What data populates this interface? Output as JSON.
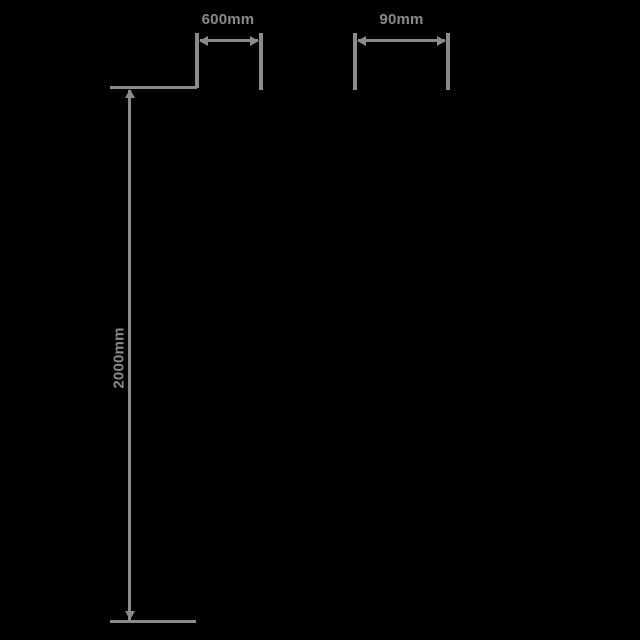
{
  "diagram": {
    "type": "product-dimension-drawing",
    "background_color": "#000000",
    "line_color": "#8a8a8a",
    "dimensions": {
      "width": {
        "label": "600mm",
        "orientation": "horizontal",
        "position": "top-left"
      },
      "depth": {
        "label": "90mm",
        "orientation": "horizontal",
        "position": "top-right"
      },
      "height": {
        "label": "2000mm",
        "orientation": "vertical",
        "position": "left"
      }
    }
  }
}
